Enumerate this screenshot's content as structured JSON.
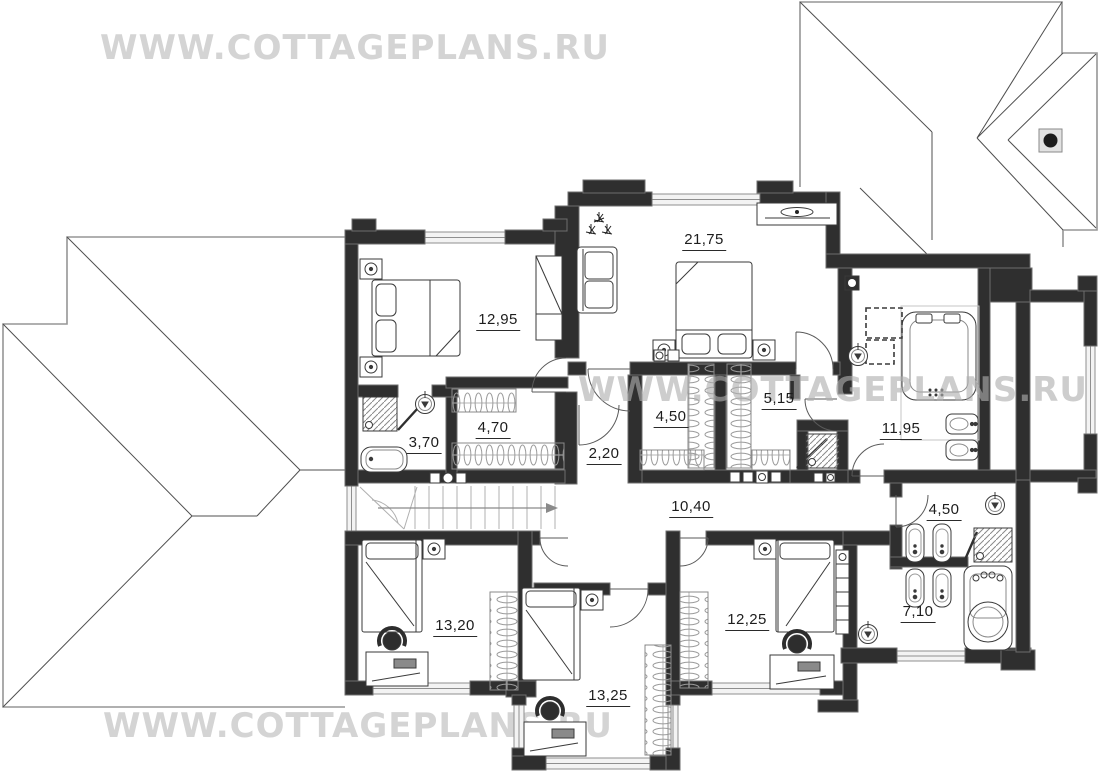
{
  "watermark": {
    "text": "WWW.COTTAGEPLANS.RU"
  },
  "plan": {
    "title": "Second floor plan",
    "rooms": [
      {
        "name": "bedroom-top-left",
        "area": "12,95"
      },
      {
        "name": "master-bedroom",
        "area": "21,75"
      },
      {
        "name": "bathroom-top-left",
        "area": "3,70"
      },
      {
        "name": "wardrobe-top-left",
        "area": "4,70"
      },
      {
        "name": "hall",
        "area": "2,20"
      },
      {
        "name": "closet-left",
        "area": "4,50"
      },
      {
        "name": "closet-right",
        "area": "5,15"
      },
      {
        "name": "bathroom-master",
        "area": "11,95"
      },
      {
        "name": "corridor",
        "area": "10,40"
      },
      {
        "name": "wc-bottom-right",
        "area": "4,50"
      },
      {
        "name": "bathroom-bottom-right",
        "area": "7,10"
      },
      {
        "name": "bedroom-bottom-left",
        "area": "13,20"
      },
      {
        "name": "bedroom-bottom-middle",
        "area": "13,25"
      },
      {
        "name": "bedroom-bottom-right",
        "area": "12,25"
      }
    ],
    "colors": {
      "background": "#ffffff",
      "walls": "#2f2f2f",
      "wall_edge": "#6e6e6e",
      "roof_lines": "#969696",
      "roof_ridges": "#4f4f4f",
      "furniture_lines": "#3a3a3a",
      "watermark": "#d4d4d4",
      "label_text": "#1d1d1d"
    }
  }
}
